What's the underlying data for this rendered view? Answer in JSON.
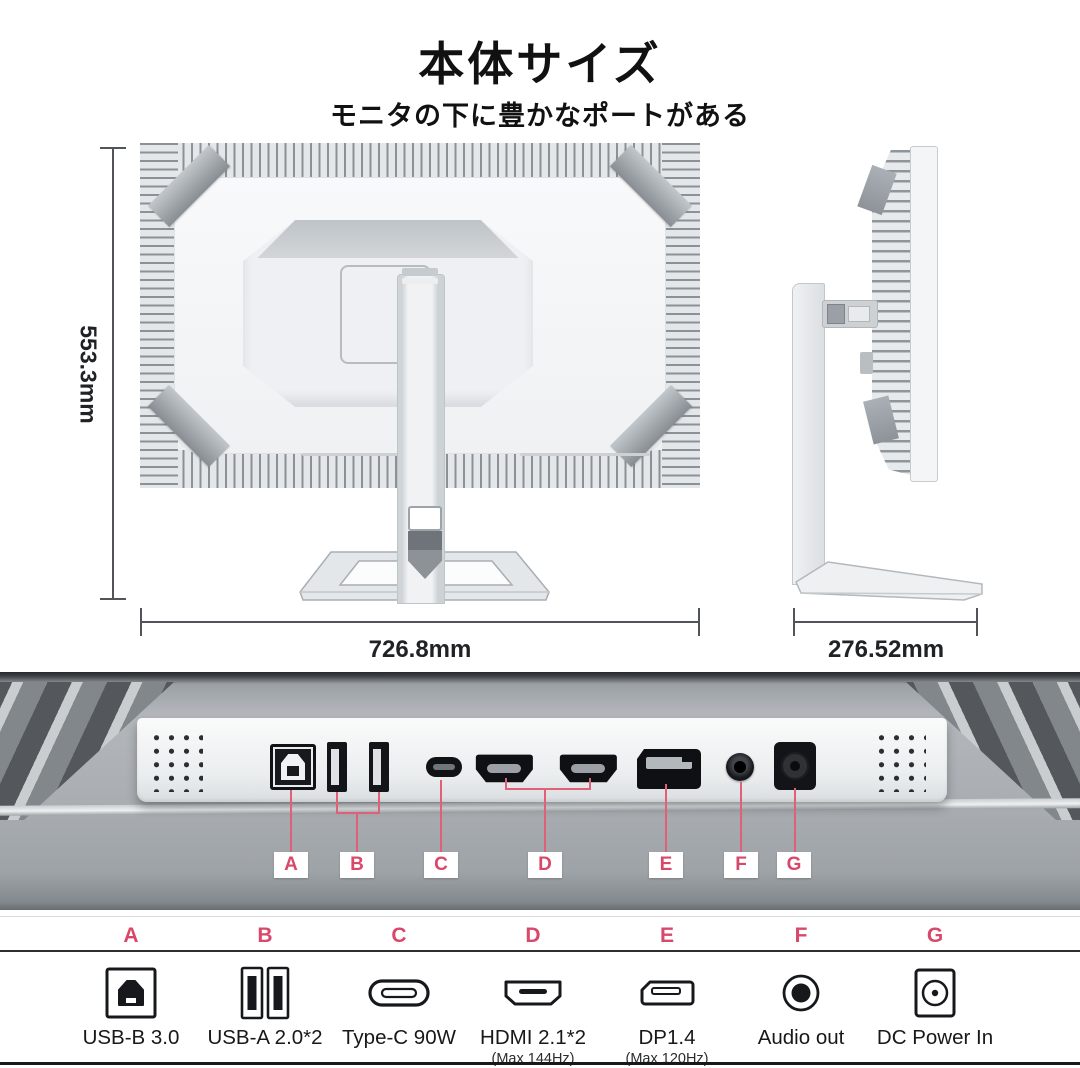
{
  "page": {
    "title": "本体サイズ",
    "subtitle": "モニタの下に豊かなポートがある"
  },
  "dimensions": {
    "height_label": "553.3mm",
    "width_label": "726.8mm",
    "depth_label": "276.52mm"
  },
  "callouts": [
    "A",
    "B",
    "C",
    "D",
    "E",
    "F",
    "G"
  ],
  "legend": {
    "items": [
      {
        "letter": "A",
        "icon": "usb-b-icon",
        "label": "USB-B 3.0",
        "sublabel": ""
      },
      {
        "letter": "B",
        "icon": "usb-a-icon",
        "label": "USB-A 2.0*2",
        "sublabel": ""
      },
      {
        "letter": "C",
        "icon": "type-c-icon",
        "label": "Type-C 90W",
        "sublabel": ""
      },
      {
        "letter": "D",
        "icon": "hdmi-icon",
        "label": "HDMI 2.1*2",
        "sublabel": "(Max 144Hz)"
      },
      {
        "letter": "E",
        "icon": "dp-icon",
        "label": "DP1.4",
        "sublabel": "(Max 120Hz)"
      },
      {
        "letter": "F",
        "icon": "audio-icon",
        "label": "Audio out",
        "sublabel": ""
      },
      {
        "letter": "G",
        "icon": "dc-icon",
        "label": "DC Power In",
        "sublabel": ""
      }
    ]
  },
  "colors": {
    "accent": "#d8486a",
    "line": "#e06078"
  }
}
